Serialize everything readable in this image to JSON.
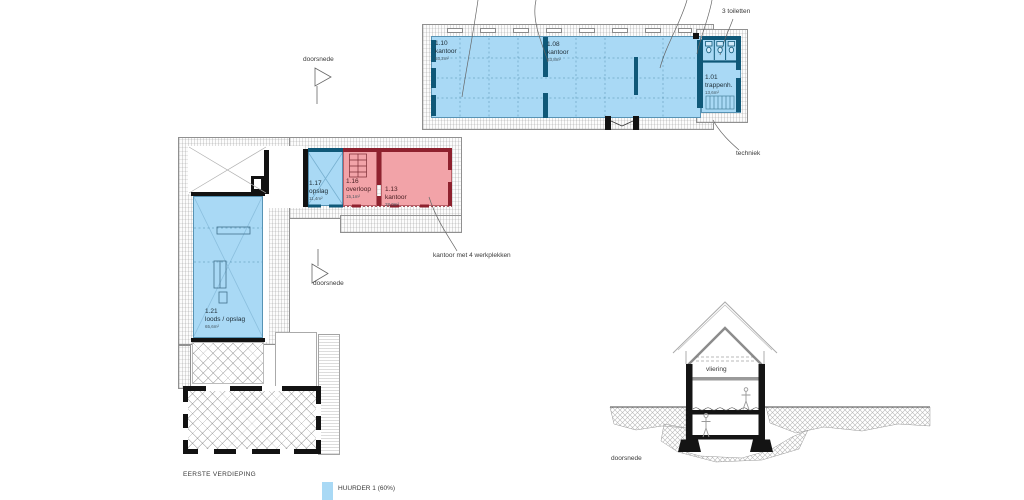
{
  "colors": {
    "tenant_blue": "#a9d9f5",
    "tenant_wall_blue": "#0f5878",
    "other_fill_pink": "#f2a3a8",
    "other_wall_red": "#8e212e"
  },
  "upper_plan": {
    "rooms": [
      {
        "id": "1.10",
        "name": "kantoor",
        "area": "53,2m²"
      },
      {
        "id": "1.08",
        "name": "kantoor",
        "area": "83,8m²"
      },
      {
        "id": "1.01",
        "name": "trappenh.",
        "area": "13,6m²"
      }
    ],
    "toilets_label": "3 toiletten",
    "techniek_label": "techniek"
  },
  "lower_plan": {
    "rooms": [
      {
        "id": "1.17",
        "name": "opslag",
        "area": "11,4m²"
      },
      {
        "id": "1.16",
        "name": "overloop",
        "area": "15,1m²"
      },
      {
        "id": "1.13",
        "name": "kantoor",
        "area": "28,0m²"
      },
      {
        "id": "1.21",
        "name": "loods / opslag",
        "area": "65,6m²"
      }
    ],
    "annotation": "kantoor met 4 werkplekken"
  },
  "section_markers": {
    "top": "doorsnede",
    "middle": "doorsnede"
  },
  "section": {
    "attic_label": "vliering",
    "caption": "doorsnede"
  },
  "footer": {
    "title": "EERSTE VERDIEPING",
    "legend": [
      {
        "label": "HUURDER 1 (60%)",
        "color": "#a9d9f5"
      }
    ]
  }
}
